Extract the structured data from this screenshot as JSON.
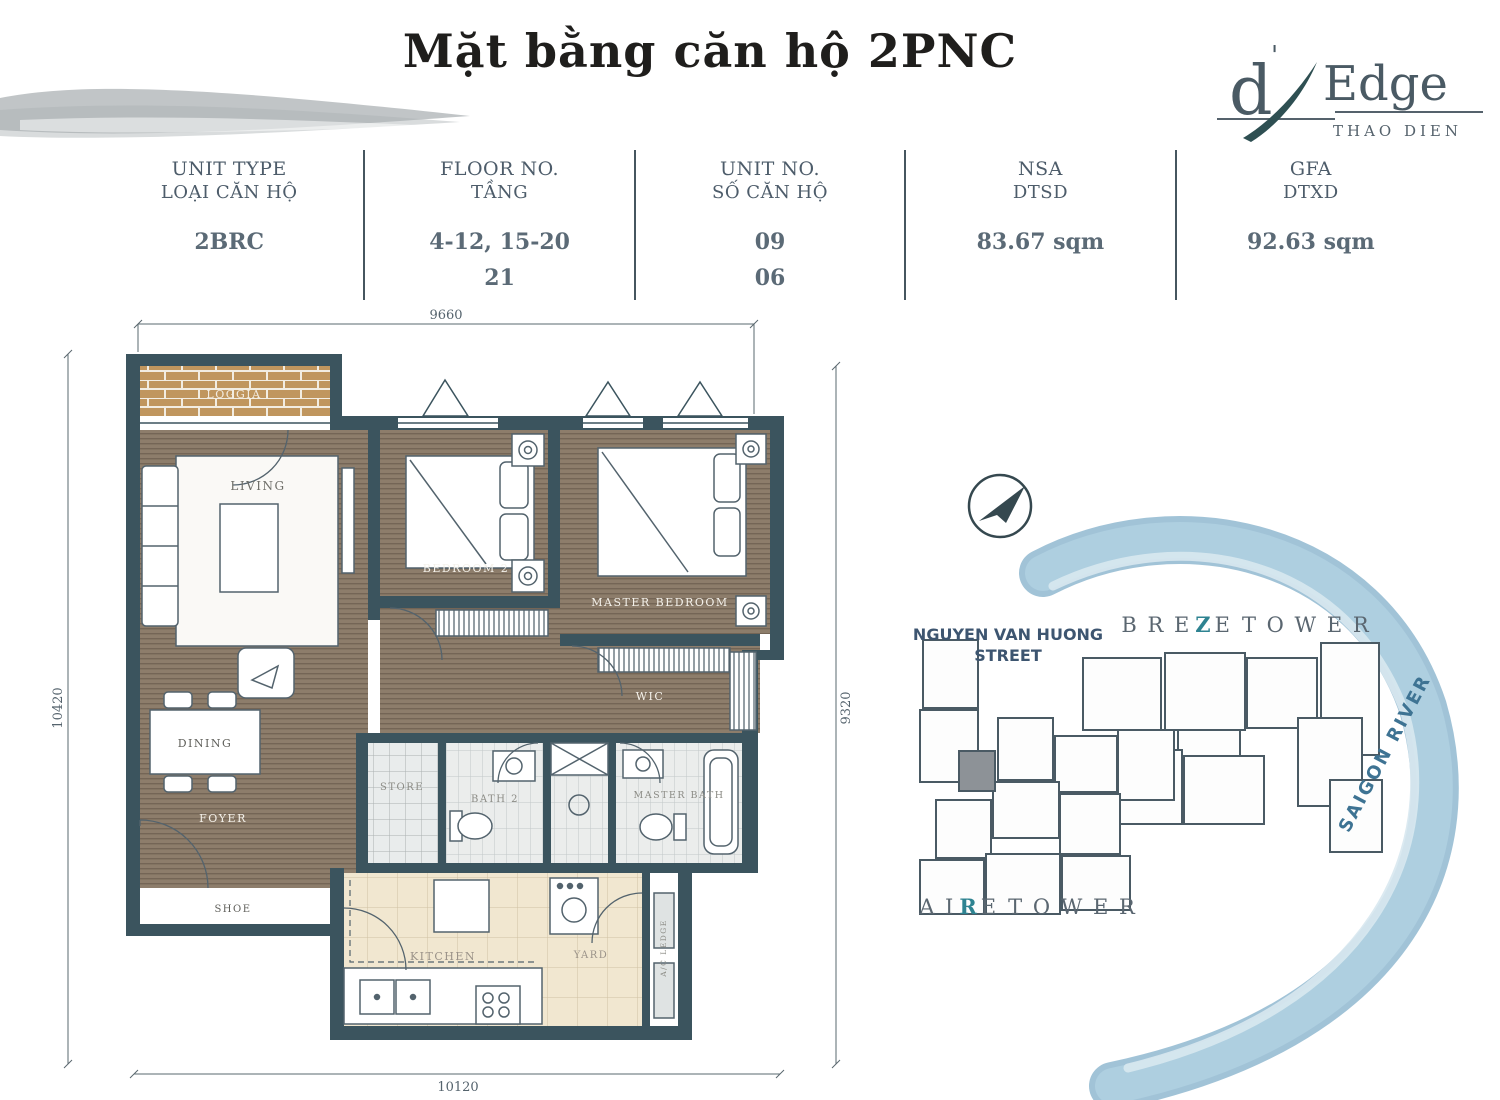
{
  "title": "Mặt bằng căn hộ 2PNC",
  "logo": {
    "d": "d",
    "apostrophe": "'",
    "edge": "Edge",
    "subtitle": "THAO DIEN"
  },
  "spec": {
    "columns": [
      {
        "en": "UNIT TYPE",
        "vi": "LOẠI CĂN HỘ",
        "values": [
          "2BRC"
        ]
      },
      {
        "en": "FLOOR NO.",
        "vi": "TẦNG",
        "values": [
          "4-12, 15-20",
          "21"
        ]
      },
      {
        "en": "UNIT NO.",
        "vi": "SỐ CĂN HỘ",
        "values": [
          "09",
          "06"
        ]
      },
      {
        "en": "NSA",
        "vi": "DTSD",
        "values": [
          "83.67 sqm"
        ]
      },
      {
        "en": "GFA",
        "vi": "DTXD",
        "values": [
          "92.63 sqm"
        ]
      }
    ]
  },
  "floor_plan": {
    "dimensions": {
      "top": "9660",
      "bottom": "10120",
      "left": "10420",
      "right": "9320"
    },
    "rooms": {
      "loggia": "LOGGIA",
      "living": "LIVING",
      "bedroom2": "BEDROOM 2",
      "master_bedroom": "MASTER BEDROOM",
      "wic": "WIC",
      "dining": "DINING",
      "foyer": "FOYER",
      "shoe": "SHOE",
      "store": "STORE",
      "bath2": "BATH 2",
      "master_bath": "MASTER BATH",
      "kitchen": "KITCHEN",
      "yard": "YARD",
      "ac_ledge": "A/C LEDGE"
    }
  },
  "site_map": {
    "street_line1": "NGUYEN VAN HUONG",
    "street_line2": "STREET",
    "breeze_tower": {
      "part1": "B R E",
      "accent": "Z",
      "part2": "E",
      "part3": "T O W E R"
    },
    "aire_tower": {
      "part1": "A I",
      "accent": "R",
      "part2": "E",
      "part3": "T O W E R"
    },
    "river": "SAIGON RIVER"
  },
  "colors": {
    "wall": "#3b545e",
    "wood": "#8d7d6b",
    "brick": "#c0965e",
    "kitchen_tile": "#f1e7d0",
    "bath_tile": "#ebedec",
    "accent_teal": "#2e8391",
    "slate_text": "#54626e",
    "title_text": "#1f1e1c",
    "river_blue": "#a8cadd",
    "highlight_unit": "#8d9297"
  }
}
